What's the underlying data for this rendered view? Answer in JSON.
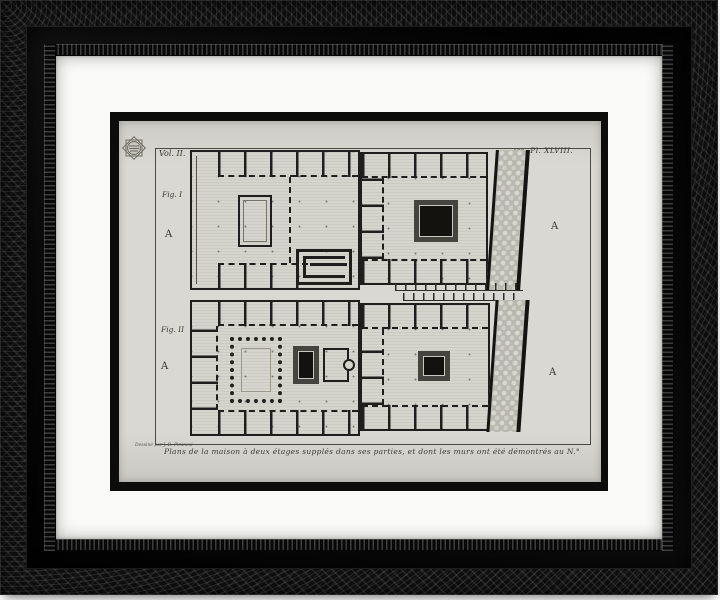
{
  "artwork": {
    "kind": "framed engraving product photo",
    "frame": {
      "style": "ornate black wood",
      "mat_color": "#fafaf8",
      "inner_mat_color": "#0c0c0b"
    },
    "plate": {
      "volume_label": "Vol. II.",
      "plate_number": "438",
      "plate_label": "Pl. XLVIII.",
      "figure1_label": "Fig. I",
      "figure2_label": "Fig. II",
      "section_marker": "A",
      "caption": "Plans de la maison à deux étages supplés dans ses parties, et dont les murs ont été démontrés au N.° 6 et 7, de la Pl. 41.",
      "credit": "Dessiné par J. B. Piranesi",
      "colors": {
        "paper": "#d9d8d2",
        "ink": "#1f1e1c"
      }
    }
  }
}
